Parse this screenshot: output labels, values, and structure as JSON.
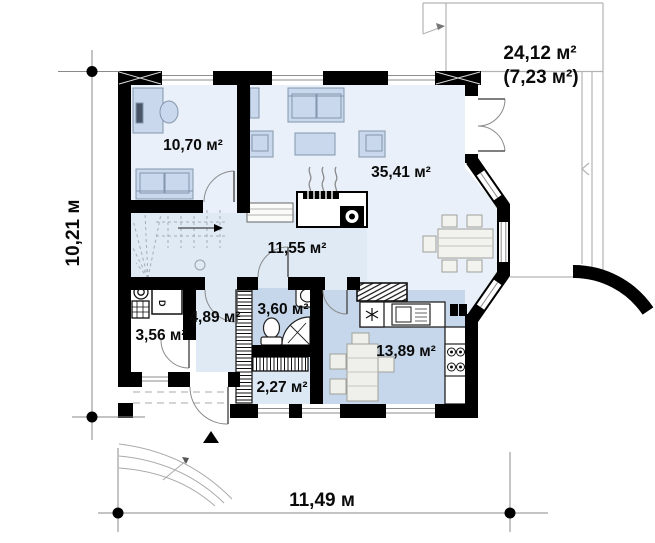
{
  "plan": {
    "rooms": [
      {
        "name": "office",
        "area": "10,70 м²"
      },
      {
        "name": "living-room",
        "area": "35,41 м²"
      },
      {
        "name": "hall",
        "area": "11,55 м²"
      },
      {
        "name": "vestibule",
        "area": "4,89 м²"
      },
      {
        "name": "bathroom",
        "area": "3,60 м²"
      },
      {
        "name": "boiler-room",
        "area": "3,56 м²"
      },
      {
        "name": "pantry",
        "area": "2,27 м²"
      },
      {
        "name": "kitchen",
        "area": "13,89 м²"
      }
    ],
    "terrace": {
      "area_total": "24,12 м²",
      "area_secondary": "(7,23 м²)"
    },
    "dimensions": {
      "height": "10,21 м",
      "width": "11,49 м"
    },
    "equipment_label": "D",
    "colors": {
      "wall": "#000000",
      "floor_light": "#e9f0f9",
      "floor_hall": "#dfeaf5",
      "floor_blue": "#c6d7eb",
      "floor_pantry": "#dce8f4",
      "furniture_blue": "#c9d8ec",
      "outline_gray": "#b3b3b3"
    }
  }
}
